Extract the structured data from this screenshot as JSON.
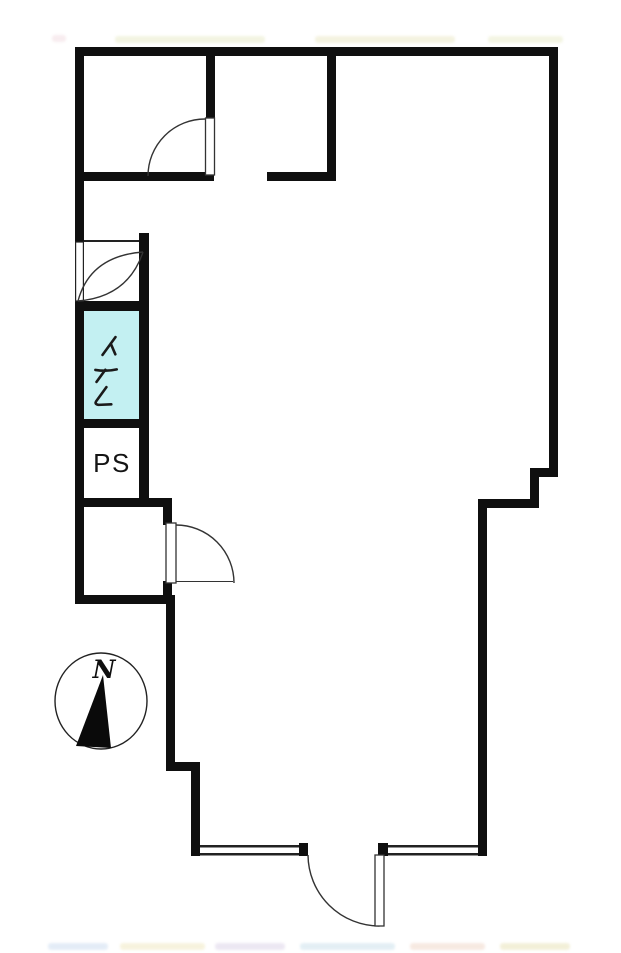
{
  "floor_plan": {
    "rooms": {
      "toilet": {
        "label": "トイレ",
        "fill_color": "#c3f0f2"
      },
      "pipe_space": {
        "label": "PS"
      }
    },
    "compass": {
      "north_label": "N"
    },
    "colors": {
      "wall": "#0f0f0f",
      "door_line": "#333333",
      "toilet_fill": "#c3f0f2",
      "background": "#ffffff"
    },
    "icons": {
      "door_swing_icon": "quarter-circle arc with door leaf",
      "toilet_door_icon": "lens shaped double-arc swing",
      "window_icon": "double-line gap in wall",
      "compass_needle_icon": "black triangle pointing north"
    }
  }
}
